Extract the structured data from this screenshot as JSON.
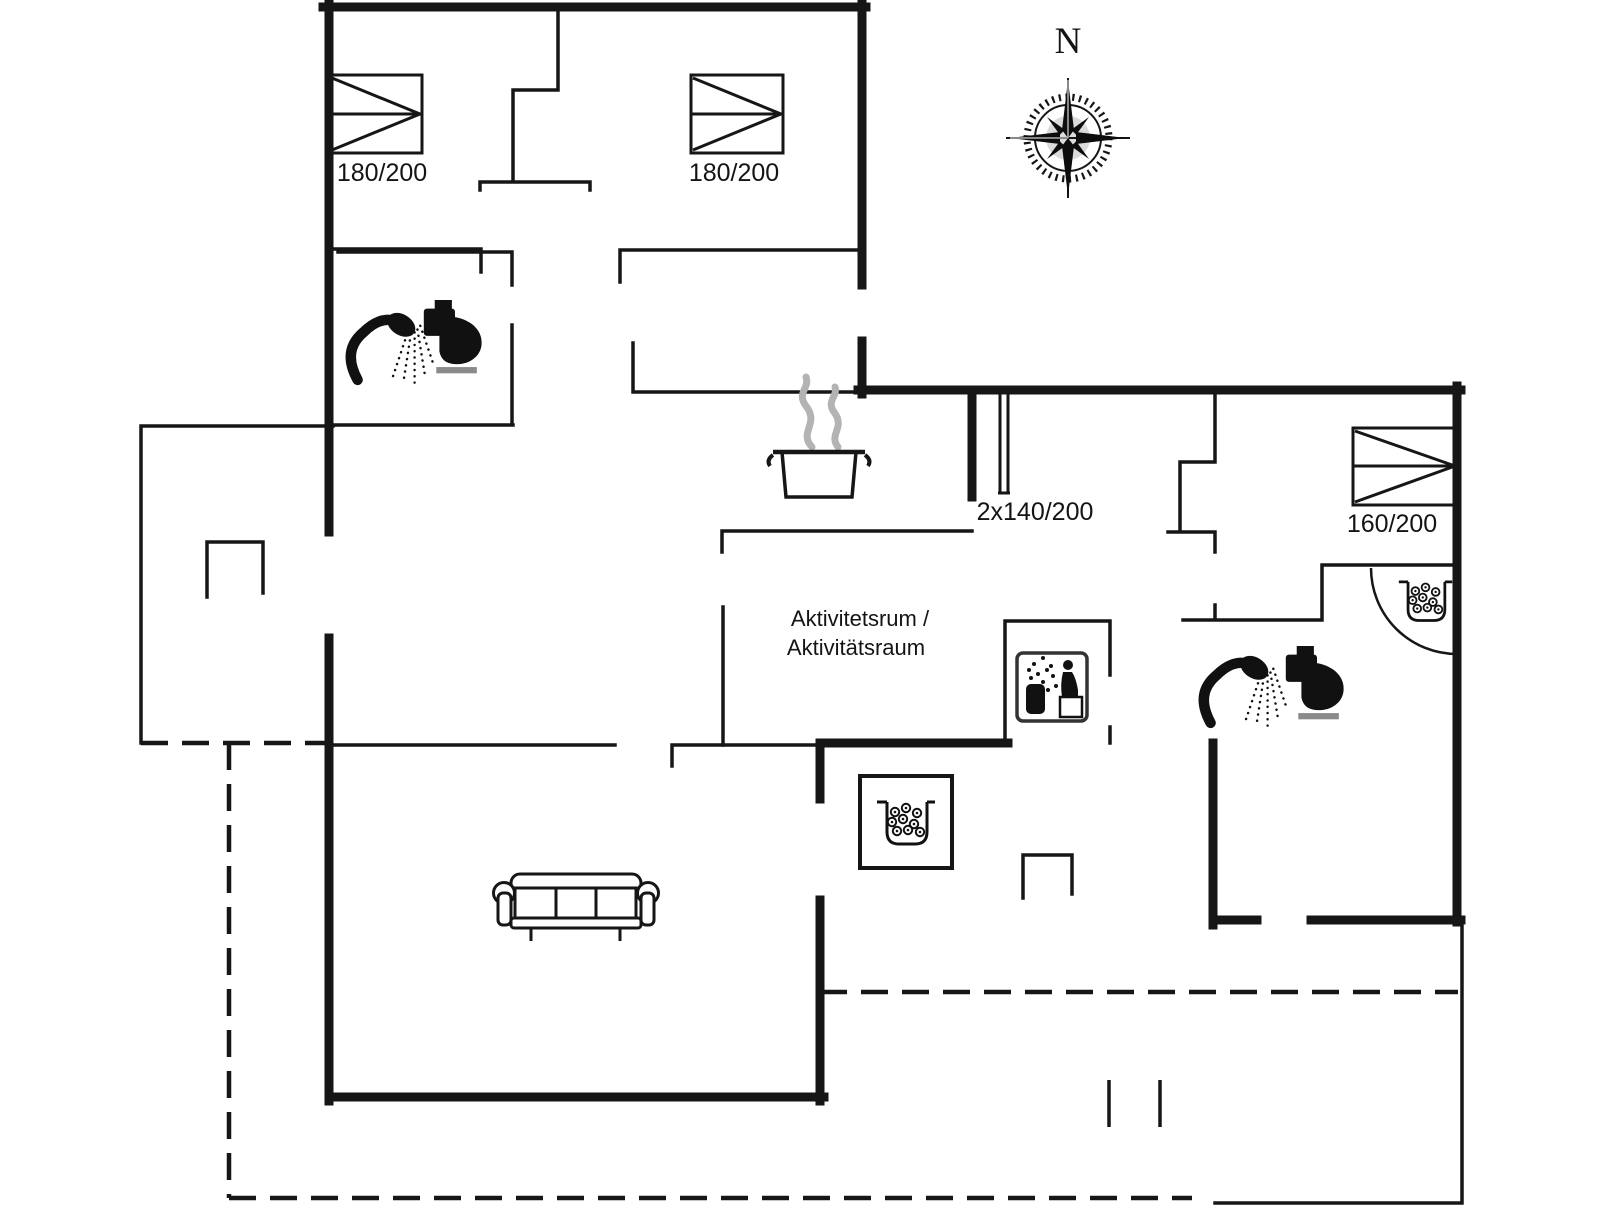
{
  "plan": {
    "title": "holiday-house-floor-plan",
    "compass": {
      "north_label": "N"
    },
    "labels": {
      "bed_top_left": "180/200",
      "bed_top_middle": "180/200",
      "bed_right": "160/200",
      "bunk_bed": "2x140/200",
      "activity_room_line1": "Aktivitetsrum /",
      "activity_room_line2": "Aktivitätsraum"
    },
    "icons": [
      "compass-rose-icon",
      "double-bed-icon",
      "bunk-bed-icon",
      "shower-icon",
      "toilet-icon",
      "cooking-pot-icon",
      "sauna-icon",
      "wood-stove-icon",
      "sofa-icon",
      "door-swing-arc"
    ],
    "colors": {
      "wall": "#161616",
      "steam": "#b3b3b3",
      "toilet_base": "#8a8a8a",
      "background": "#ffffff"
    }
  }
}
